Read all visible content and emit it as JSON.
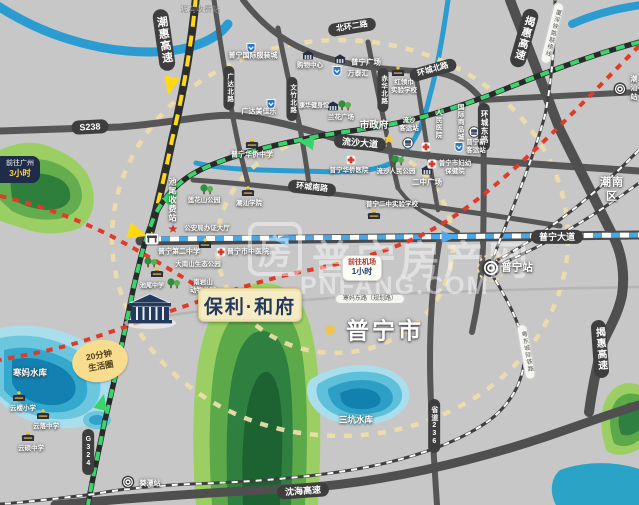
{
  "colors": {
    "background": "#c7c7c7",
    "road": "#565656",
    "road_pill": "#3e3e3e",
    "water": "#2b9cd1",
    "park_green": "#9ccf63",
    "ring_dash_beige": "#ecddab",
    "expressway_dash_yellow": "#ffd816",
    "road_dash_green": "#3bd36c",
    "avenue_dash_blue": "#4aa7e6",
    "railway_red": "#e23a28",
    "logo_bg": "#f6ecc3",
    "logo_text": "#24395e",
    "badge_yellow": "#f7dd8d"
  },
  "map": {
    "city": "普宁市",
    "district": "潮南区",
    "watermark": {
      "logo_glyph": "房",
      "site_name": "普宁房产网",
      "domain": "PNFANG.COM"
    },
    "project": {
      "logo": "保利·和府"
    },
    "badges": {
      "guangzhou_line1": "前往广州",
      "guangzhou_line2": "3小时",
      "airport_line1": "前往机场",
      "airport_line2": "1小时",
      "life_circle": "20分钟\n生活圈"
    },
    "roads": {
      "chaohui_expwy": "潮惠高速",
      "jiehui_expwy_top": "揭惠高速",
      "jiehui_expwy_bottom": "揭惠高速",
      "shenhai_expwy": "沈海高速",
      "s238": "S238",
      "g324": "G324",
      "sd236": "省道236",
      "beihuan_2nd": "北环二路",
      "huancheng_north": "环城北路",
      "huancheng_east": "环城东路",
      "huancheng_south": "环城南路",
      "liusha_ave": "流沙大道",
      "puning_ave": "普宁大道",
      "guangda_north": "广达北路",
      "wenzhu_north": "文竹北路",
      "chihua_north": "赤华北路",
      "hanma_east": "寒妈东路（规划路）"
    },
    "railways": {
      "xiashen_link": "厦深铁路联络线",
      "yuedong_intercity": "粤东城际铁路"
    },
    "stations": {
      "puning": "普宁站",
      "kuitan": "葵潭站",
      "chaoshan": "潮汕站"
    },
    "tolls": {
      "nigou": "泥沟收费站",
      "chiwei": "池尾收费站"
    },
    "waters": {
      "hanma": "寒妈水库",
      "sankeng": "三坑水库"
    },
    "pois": {
      "clothing_city": "普宁国际服装城",
      "guangda_mall": "广达美佳乐",
      "puning_plaza": "普宁广场",
      "wantaihui": "万泰汇",
      "shopping_center": "购物中心",
      "honglingjin_school": "红领巾\n实验学校",
      "city_gov": "市政府",
      "liusha_bus_station": "流沙\n客运站",
      "people_hospital": "人民医院",
      "intl_commodity_city": "国际商品城",
      "new_bus_station": "普宁新\n客运站",
      "overseas_hospital": "普宁华侨医院",
      "liusha_park": "流沙人民公园",
      "fuyou_hospital": "普宁市妇幼\n保健院",
      "erzhong_plaza": "二中广场",
      "lianhuashan_park": "莲花山公园",
      "chaoshan_college": "潮汕学院",
      "overseas_middle": "普宁华侨中学",
      "police_hall": "公安局办证大厅",
      "no2_middle": "普宁第二中学",
      "tcm_hospital": "普宁市中医院",
      "erzhong_exp_school": "普宁二中实验学校",
      "lanhua_plaza": "兰花广场",
      "kanghua_gym": "康华健身馆",
      "nanshan_park": "大南山生态公园",
      "zoo_park": "南岩山\n动物公园",
      "chiwei_middle": "池尾中学",
      "yunlou_primary": "云楼小学",
      "yunluo_middle": "云落中学",
      "yunshuo_middle": "云硕中学"
    }
  }
}
